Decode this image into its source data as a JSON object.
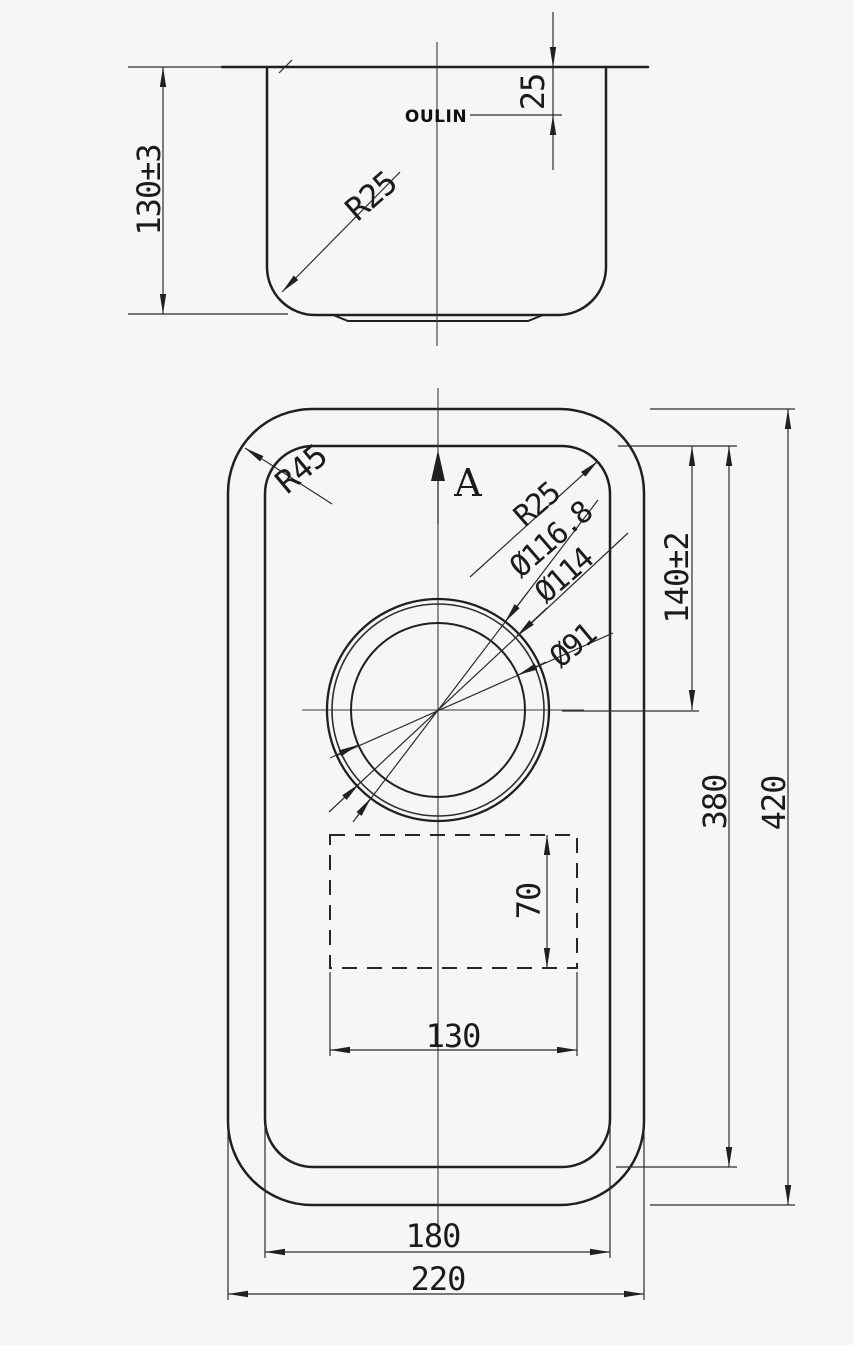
{
  "drawing": {
    "brand_logo": "OULIN",
    "side_view": {
      "depth": "130±3",
      "rim_to_logo": "25",
      "bottom_corner_radius": "R25"
    },
    "plan_view": {
      "outer_corner_radius": "R45",
      "section_label": "A",
      "bowl_corner_radius": "R25",
      "drain_dia_outer": "Ø116.8",
      "drain_dia_mid": "Ø114",
      "drain_dia_inner": "Ø91",
      "top_to_drain_center": "140±2",
      "bowl_length": "380",
      "overall_length": "420",
      "recess_height": "70",
      "recess_width": "130",
      "bowl_width": "180",
      "overall_width": "220"
    }
  }
}
